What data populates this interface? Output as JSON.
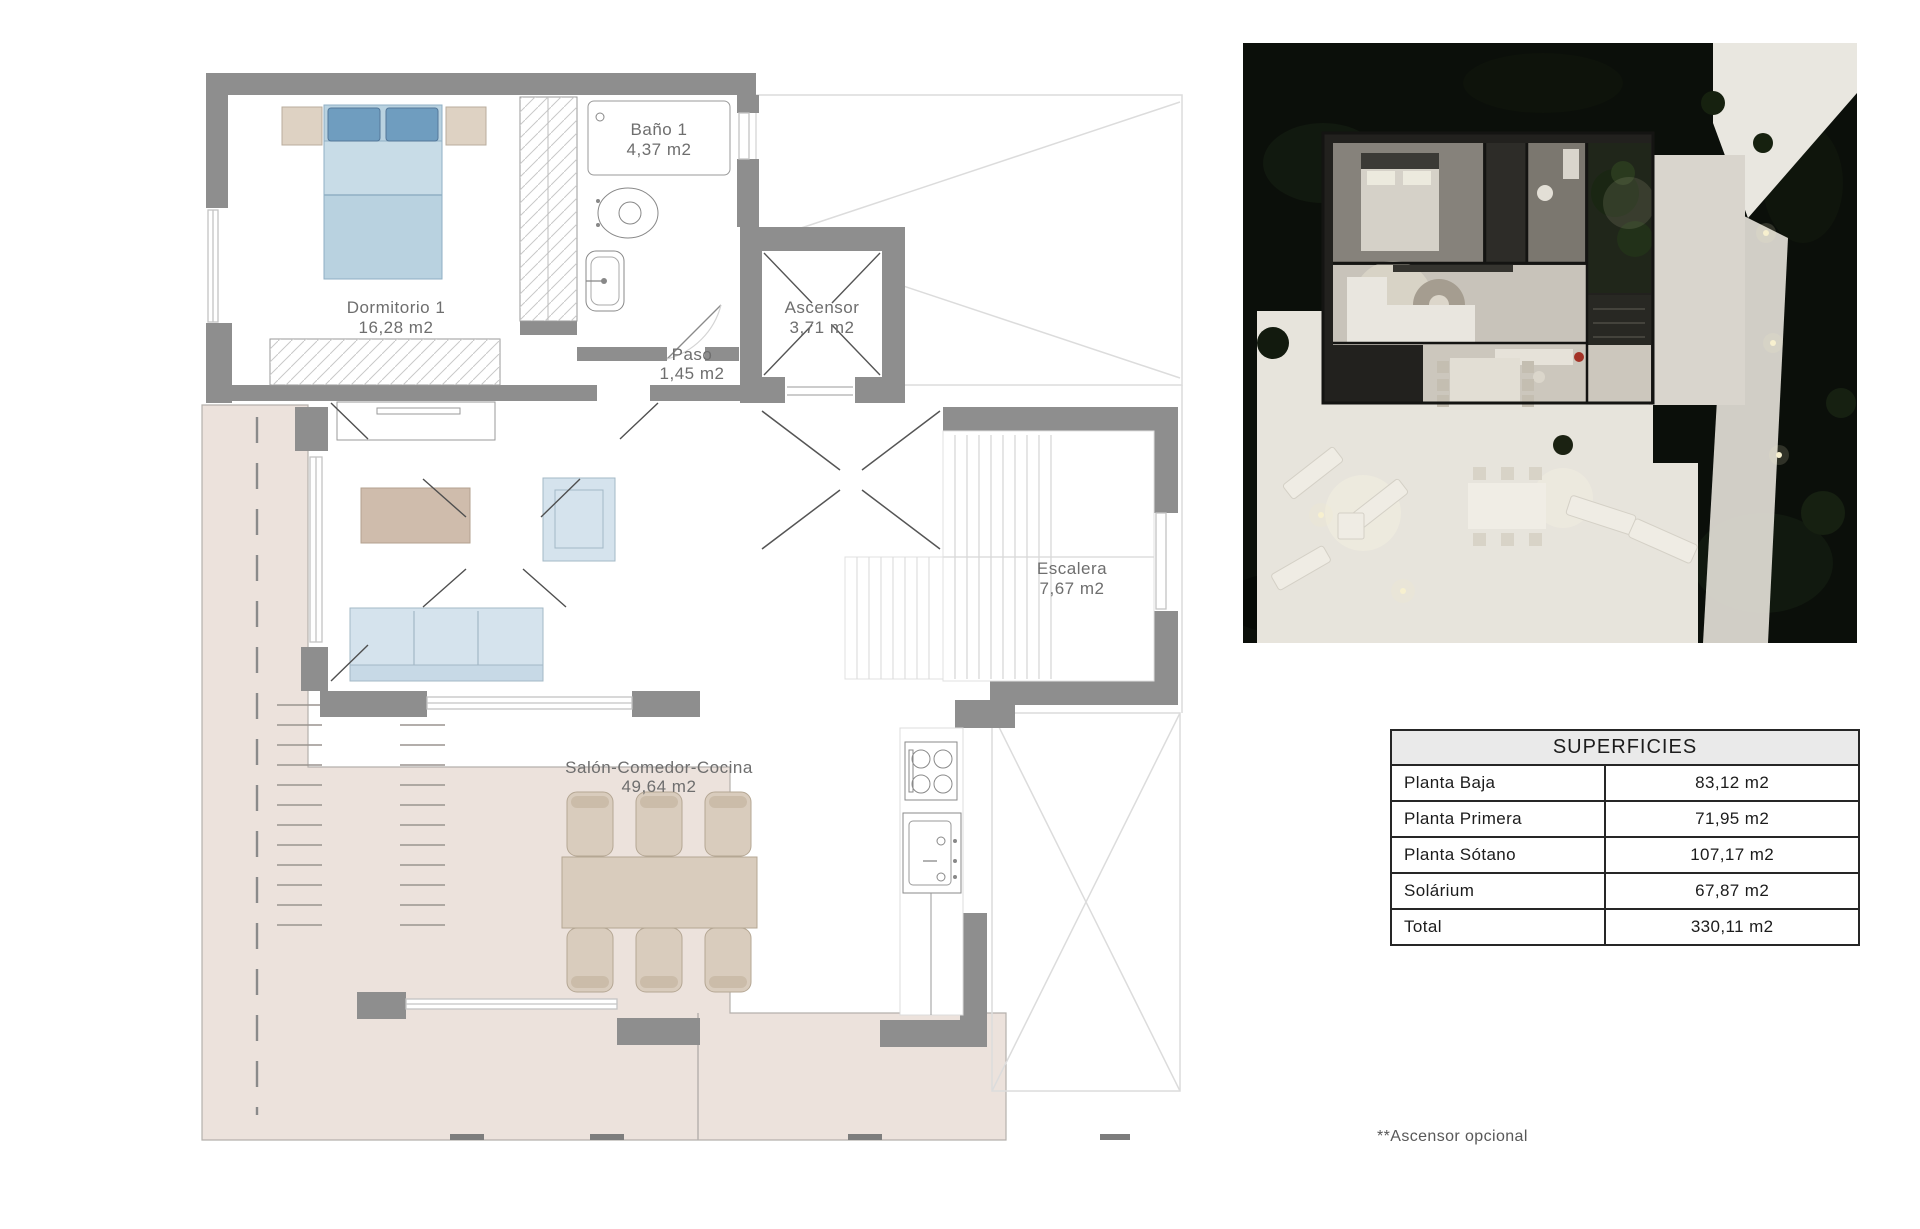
{
  "plan": {
    "rooms": [
      {
        "name": "Dormitorio 1",
        "area": "16,28 m2"
      },
      {
        "name": "Baño 1",
        "area": "4,37 m2"
      },
      {
        "name": "Paso",
        "area": "1,45 m2"
      },
      {
        "name": "Ascensor",
        "area": "3,71 m2"
      },
      {
        "name": "Escalera",
        "area": "7,67 m2"
      },
      {
        "name": "Salón-Comedor-Cocina",
        "area": "49,64 m2"
      }
    ]
  },
  "table": {
    "title": "SUPERFICIES",
    "rows": [
      {
        "label": "Planta Baja",
        "value": "83,12 m2"
      },
      {
        "label": "Planta Primera",
        "value": "71,95 m2"
      },
      {
        "label": "Planta Sótano",
        "value": "107,17 m2"
      },
      {
        "label": "Solárium",
        "value": "67,87 m2"
      },
      {
        "label": "Total",
        "value": "330,11 m2"
      }
    ]
  },
  "footnote": "**Ascensor opcional",
  "colors": {
    "wall": "#8e8e8e",
    "terrace": "#ece2dc",
    "bed_blue": "#b9d2e0",
    "pillow_blue": "#6f9dbf",
    "sofa_blue": "#d5e3ed",
    "wood": "#d9ccbd",
    "table_header_bg": "#eaeaea",
    "label_text": "#6e6e6e"
  }
}
